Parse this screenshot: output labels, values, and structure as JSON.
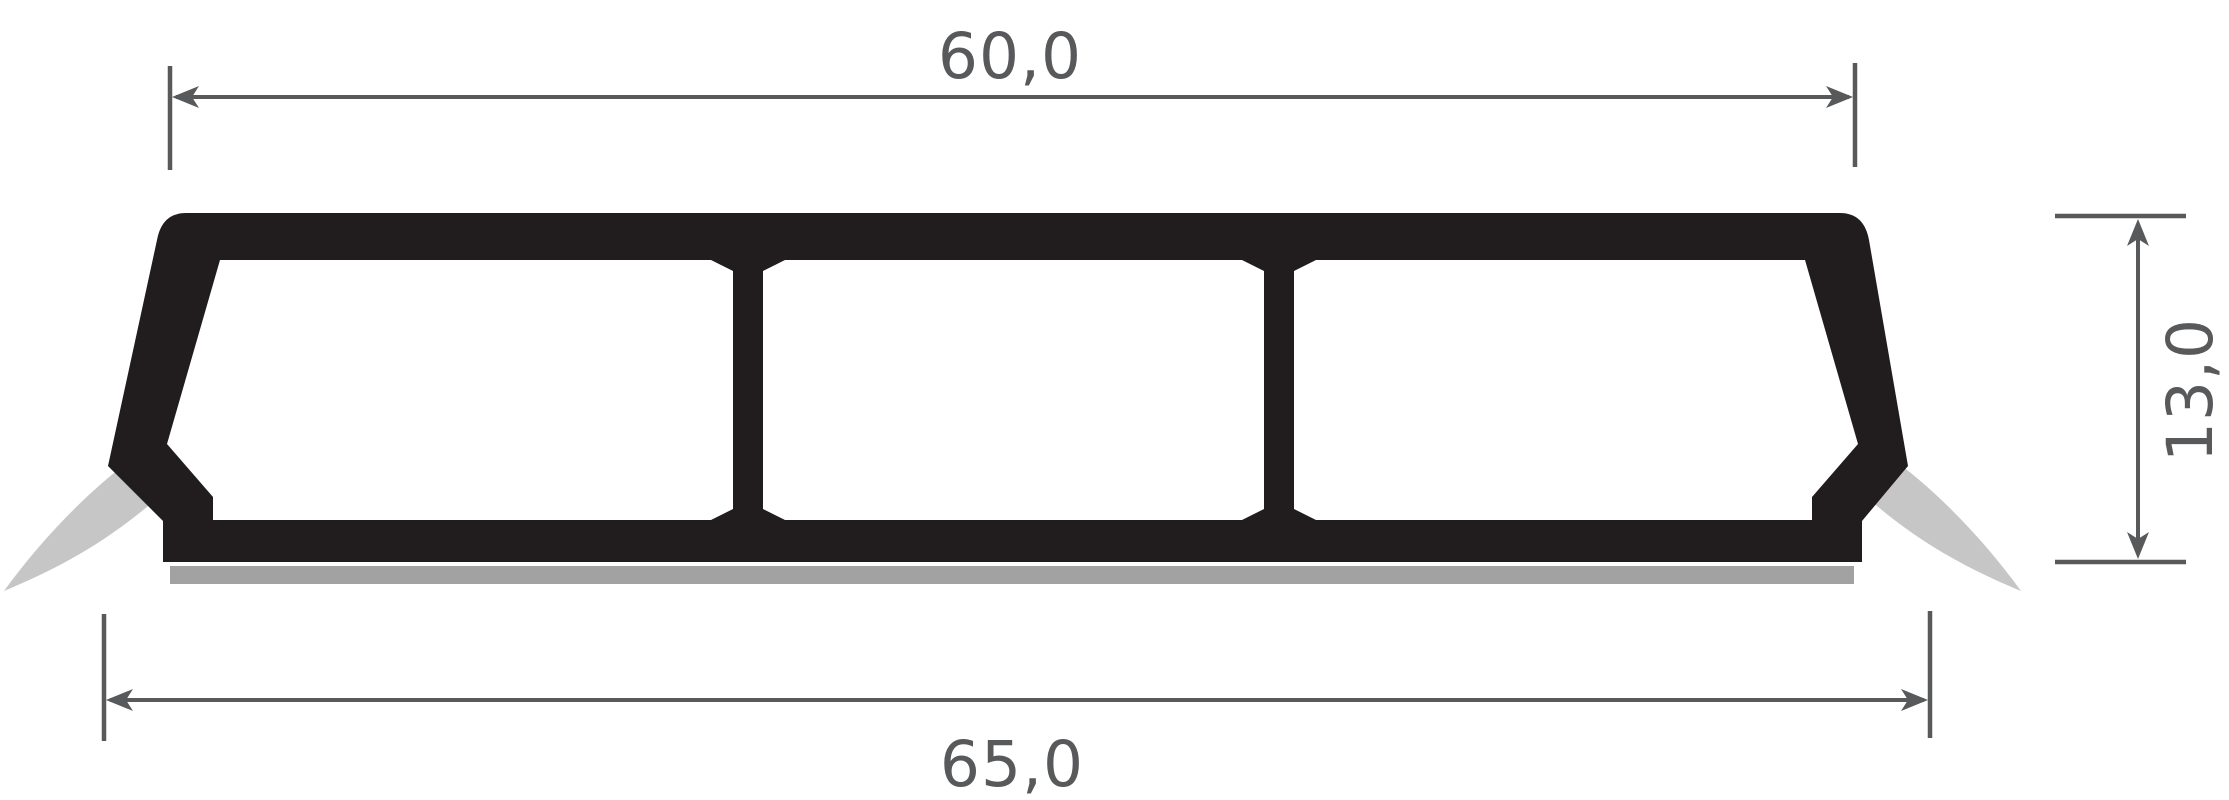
{
  "diagram": {
    "kind": "technical cross-section drawing",
    "subject": "threshold ramp profile with flexible lips and adhesive strip",
    "chamber_count": 3,
    "dimensions": {
      "top_width": {
        "label": "60,0"
      },
      "bottom_width": {
        "label": "65,0"
      },
      "height": {
        "label": "13,0"
      }
    },
    "colors": {
      "body": "#211d1e",
      "flexible_lip": "#c6c6c6",
      "adhesive_strip": "#a2a2a2",
      "dimension_lines": "#58595b",
      "background": "#ffffff"
    }
  }
}
